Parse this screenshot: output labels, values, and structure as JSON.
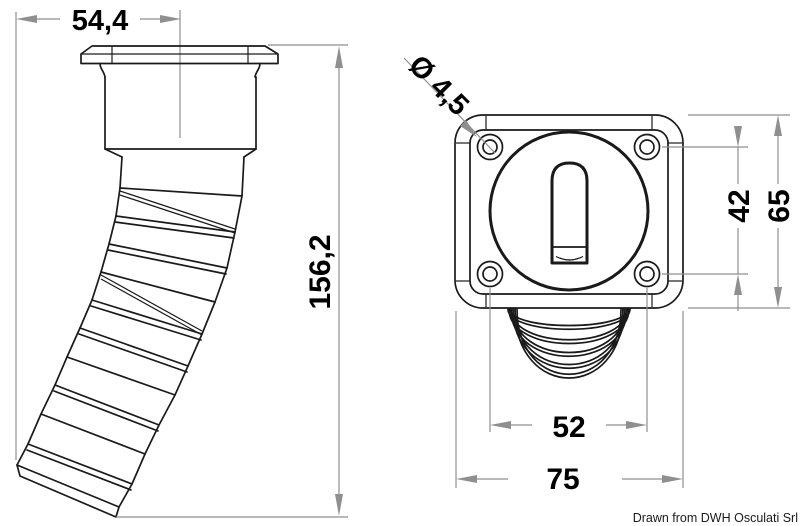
{
  "drawing": {
    "type": "technical-orthographic-drawing",
    "subject": "deck drain fitting with corrugated hose",
    "dimensions": {
      "flange_width": "54,4",
      "overall_height": "156,2",
      "screw_hole_diameter": "Ø 4,5",
      "hole_pitch_vertical": "42",
      "plate_height": "65",
      "hole_pitch_horizontal": "52",
      "plate_width": "75"
    },
    "footer": {
      "credit": "Drawn from DWH Osculati Srl"
    },
    "colors": {
      "background": "#ffffff",
      "outline": "#1a1a1a",
      "dimension_lines": "#8f8f8f",
      "text": "#000000"
    }
  }
}
